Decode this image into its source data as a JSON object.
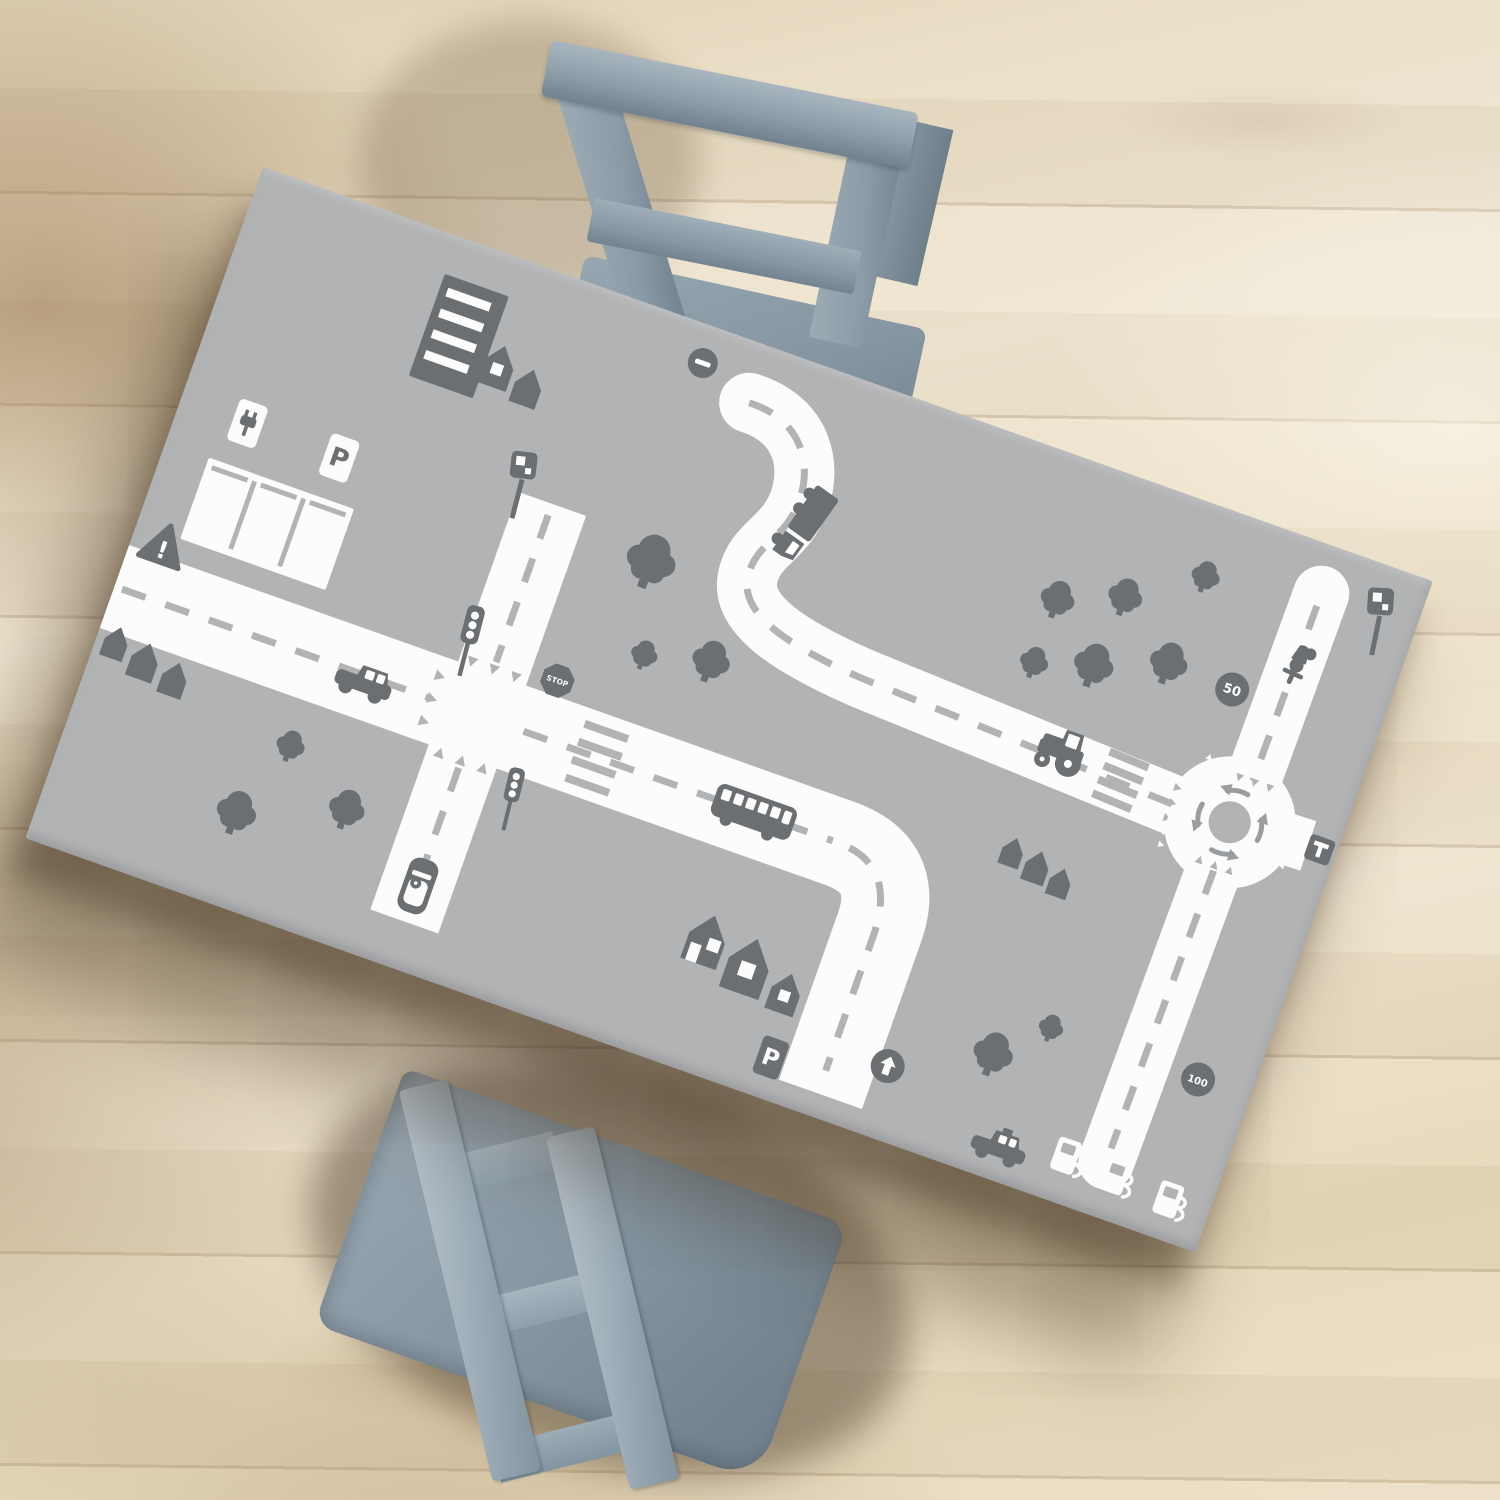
{
  "scene": {
    "title": "Kids play table with gray road traffic mat, two blue-gray chairs on light wood floor"
  },
  "palette": {
    "table_top": "#b2b3b5",
    "icon_gray": "#6c6f71",
    "road_white": "#fcfcfd",
    "dash_gray": "#b2b3b5",
    "arrow_gray": "#9a9da0",
    "shadow_brown": "#3e2e1a"
  },
  "signs": {
    "stop": "STOP",
    "speed_50": "50",
    "speed_100": "100",
    "parking": "P",
    "dead_end": "T",
    "warning": "!"
  },
  "mat": {
    "width": 1241,
    "height": 712,
    "roads": [
      {
        "name": "main-road",
        "d": "M -20 445 L 769 445 Q 835 445 835 511 L 835 688",
        "w": 88,
        "cap": "butt"
      },
      {
        "name": "cross-road",
        "d": "M 385 221 L 385 664",
        "w": 72,
        "cap": "butt"
      },
      {
        "name": "winding-road",
        "d": "M 537 60 C 595 58 618 100 617 138 C 616 178 589 190 594 226 C 600 262 654 276 734 282 L 1078 298",
        "w": 60,
        "cap": "round"
      },
      {
        "name": "roundabout-north-road",
        "d": "M 1140 49 L 1138 258",
        "w": 56,
        "cap": "round"
      },
      {
        "name": "roundabout-south-road",
        "d": "M 1131 334 L 1127 656",
        "w": 56,
        "cap": "round"
      },
      {
        "name": "roundabout-east-stub",
        "d": "M 1178 292 L 1212 291",
        "w": 52,
        "cap": "butt"
      }
    ],
    "dashes": [
      "M 8 445 L 336 445",
      "M 434 445 L 762 445",
      "M 780 446 Q 831 453 832 520 L 832 664",
      "M 385 233 L 385 389",
      "M 385 501 L 385 650",
      "M 537 60 C 595 58 618 100 617 138 C 616 178 589 190 594 226 C 600 262 654 276 734 282 L 1070 297",
      "M 1140 62 L 1138 248",
      "M 1131 346 L 1127 642"
    ],
    "roundabout": {
      "cx": 1130,
      "cy": 295,
      "ring_r": 43.5,
      "ring_w": 45,
      "island_r": 21,
      "arrow_count": 4
    },
    "crossings": [
      {
        "name": "zebra-crossing",
        "x": 512,
        "y": 446,
        "rot": 0,
        "len": 46,
        "n": 4,
        "gap": 19
      },
      {
        "name": "zebra-crossing",
        "x": 1013,
        "y": 292,
        "rot": 3,
        "len": 42,
        "n": 4,
        "gap": 15
      }
    ],
    "teeth": [
      {
        "x": 332,
        "y": 445,
        "dir": "right",
        "n": 3,
        "gap": 24,
        "s": 1,
        "c": "dash"
      },
      {
        "x": 385,
        "y": 392,
        "dir": "down",
        "n": 3,
        "gap": 23,
        "s": 1,
        "c": "dash"
      },
      {
        "x": 385,
        "y": 498,
        "dir": "up",
        "n": 3,
        "gap": 23,
        "s": 1,
        "c": "dash"
      },
      {
        "x": 1140,
        "y": 246,
        "dir": "down",
        "n": 3,
        "gap": 16,
        "s": 0.75,
        "c": "dash"
      },
      {
        "x": 1066,
        "y": 296,
        "dir": "right",
        "n": 3,
        "gap": 16,
        "s": 0.75,
        "c": "dash"
      },
      {
        "x": 1130,
        "y": 344,
        "dir": "up",
        "n": 3,
        "gap": 16,
        "s": 0.75,
        "c": "dash"
      },
      {
        "x": 1070,
        "y": 326,
        "dir": "right",
        "n": 3,
        "gap": 13,
        "s": 0.6,
        "c": "road"
      },
      {
        "x": 1102,
        "y": 243,
        "dir": "up",
        "n": 3,
        "gap": 13,
        "s": 0.6,
        "c": "road"
      },
      {
        "x": 1196,
        "y": 312,
        "dir": "left",
        "n": 2,
        "gap": 13,
        "s": 0.6,
        "c": "road"
      }
    ],
    "elements": [
      {
        "type": "building",
        "name": "apartment-building",
        "x": 241,
        "y": 94
      },
      {
        "type": "house",
        "name": "house",
        "x": 288,
        "y": 110,
        "s": 1.05,
        "opts": {
          "window": true
        }
      },
      {
        "type": "house",
        "name": "house",
        "x": 323,
        "y": 120,
        "s": 0.92
      },
      {
        "type": "parking_lot",
        "name": "parking-lot",
        "x": 123,
        "y": 335
      },
      {
        "type": "sign_ev",
        "name": "ev-charging-sign",
        "x": 71,
        "y": 247
      },
      {
        "type": "sign_p",
        "name": "parking-sign",
        "x": 169,
        "y": 249,
        "label_key": "parking"
      },
      {
        "type": "sign_warning",
        "name": "warning-sign",
        "x": 33,
        "y": 388,
        "label_key": "warning"
      },
      {
        "type": "camera",
        "name": "speed-camera",
        "x": 352,
        "y": 248,
        "rot": -5
      },
      {
        "type": "sign_no_entry",
        "name": "no-entry-sign",
        "x": 480,
        "y": 38
      },
      {
        "type": "traffic_light",
        "name": "traffic-light",
        "x": 355,
        "y": 414,
        "s": 0.9,
        "rot": -5
      },
      {
        "type": "traffic_light",
        "name": "traffic-light",
        "x": 448,
        "y": 545,
        "s": 0.8,
        "rot": -6
      },
      {
        "type": "sign_stop",
        "name": "stop-sign",
        "x": 449,
        "y": 386,
        "label_key": "stop"
      },
      {
        "type": "car",
        "name": "car",
        "x": 267,
        "y": 452
      },
      {
        "type": "bus",
        "name": "bus",
        "x": 678,
        "y": 444
      },
      {
        "type": "car_top",
        "name": "parked-car",
        "x": 386,
        "y": 626
      },
      {
        "type": "truck",
        "name": "truck",
        "x": 629,
        "y": 156,
        "rot": 106
      },
      {
        "type": "tractor",
        "name": "tractor",
        "x": 948,
        "y": 288
      },
      {
        "type": "scooter",
        "name": "scooter-rider",
        "x": 1141,
        "y": 121,
        "rot": 185
      },
      {
        "type": "taxi",
        "name": "taxi",
        "x": 1021,
        "y": 678
      },
      {
        "type": "sign_p",
        "name": "parking-sign",
        "x": 776,
        "y": 670,
        "s": 0.9,
        "label_key": "parking",
        "opts": {
          "inverted": true
        }
      },
      {
        "type": "sign_arrow",
        "name": "ahead-only-sign",
        "x": 889,
        "y": 639
      },
      {
        "type": "camera",
        "name": "speed-camera",
        "x": 1208,
        "y": 90,
        "rot": -8
      },
      {
        "type": "sign_circle",
        "name": "speed-limit-50-sign",
        "x": 1088,
        "y": 169,
        "label_key": "speed_50"
      },
      {
        "type": "sign_circle",
        "name": "speed-limit-100-sign",
        "x": 1186,
        "y": 548,
        "label_key": "speed_100"
      },
      {
        "type": "sign_t",
        "name": "dead-end-sign",
        "x": 1224,
        "y": 291,
        "label_key": "dead_end"
      },
      {
        "type": "pump",
        "name": "fuel-pump",
        "x": 1087,
        "y": 664
      },
      {
        "type": "pump",
        "name": "fuel-pump",
        "x": 1140,
        "y": 667
      },
      {
        "type": "pump",
        "name": "fuel-pump",
        "x": 1198,
        "y": 671
      },
      {
        "type": "house",
        "name": "house",
        "x": 20,
        "y": 498,
        "s": 0.8
      },
      {
        "type": "house",
        "name": "house",
        "x": 53,
        "y": 506,
        "s": 0.92
      },
      {
        "type": "house",
        "name": "house",
        "x": 87,
        "y": 513,
        "s": 0.85
      },
      {
        "type": "house",
        "name": "house",
        "x": 935,
        "y": 396,
        "s": 0.72
      },
      {
        "type": "house",
        "name": "house",
        "x": 963,
        "y": 402,
        "s": 0.8
      },
      {
        "type": "house",
        "name": "house",
        "x": 990,
        "y": 409,
        "s": 0.72
      },
      {
        "type": "house",
        "name": "house",
        "x": 676,
        "y": 581,
        "s": 1.25,
        "opts": {
          "door": true
        }
      },
      {
        "type": "house",
        "name": "house",
        "x": 724,
        "y": 592,
        "s": 1.4,
        "opts": {
          "window": true
        }
      },
      {
        "type": "house",
        "name": "house",
        "x": 768,
        "y": 605,
        "s": 1.0,
        "opts": {
          "window": true
        }
      },
      {
        "type": "tree",
        "name": "tree",
        "x": 190,
        "y": 618,
        "s": 1.05
      },
      {
        "type": "tree",
        "name": "tree",
        "x": 219,
        "y": 537,
        "s": 0.75
      },
      {
        "type": "tree",
        "name": "tree",
        "x": 293,
        "y": 578,
        "s": 0.95
      },
      {
        "type": "tree",
        "name": "tree",
        "x": 497,
        "y": 243,
        "s": 1.3
      },
      {
        "type": "tree",
        "name": "tree",
        "x": 522,
        "y": 333,
        "s": 0.7
      },
      {
        "type": "tree",
        "name": "tree",
        "x": 587,
        "y": 317,
        "s": 1.0
      },
      {
        "type": "tree",
        "name": "tree",
        "x": 893,
        "y": 143,
        "s": 0.9
      },
      {
        "type": "tree",
        "name": "tree",
        "x": 892,
        "y": 210,
        "s": 0.75
      },
      {
        "type": "tree",
        "name": "tree",
        "x": 949,
        "y": 193,
        "s": 1.05
      },
      {
        "type": "tree",
        "name": "tree",
        "x": 956,
        "y": 118,
        "s": 0.9
      },
      {
        "type": "tree",
        "name": "tree",
        "x": 1019,
        "y": 166,
        "s": 1.0
      },
      {
        "type": "tree",
        "name": "tree",
        "x": 1025,
        "y": 72,
        "s": 0.75
      },
      {
        "type": "tree",
        "name": "tree",
        "x": 984,
        "y": 593,
        "s": 1.05
      },
      {
        "type": "tree",
        "name": "tree",
        "x": 1030,
        "y": 549,
        "s": 0.65
      }
    ]
  }
}
